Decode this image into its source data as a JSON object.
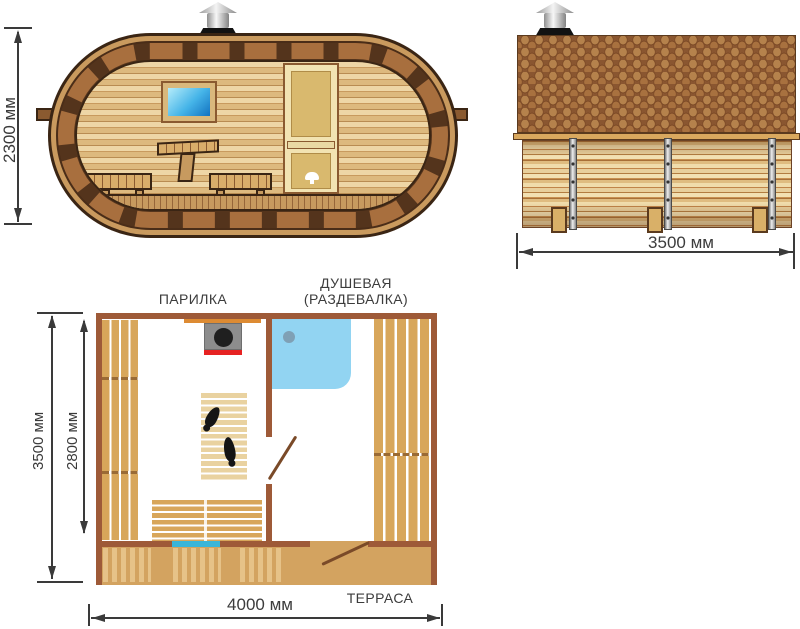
{
  "front_view": {
    "height_dimension": "2300 мм"
  },
  "side_view": {
    "length_dimension": "3500 мм"
  },
  "floor_plan": {
    "room_labels": {
      "steam_room": "ПАРИЛКА",
      "shower_line1": "ДУШЕВАЯ",
      "shower_line2": "(РАЗДЕВАЛКА)",
      "terrace": "ТЕРРАСА"
    },
    "dimensions": {
      "overall_depth": "3500 мм",
      "interior_depth": "2800 мм",
      "overall_width": "4000 мм"
    }
  },
  "colors": {
    "plan_wall_brown": "#9e5a38",
    "wood_tan": "#d8a65a",
    "barrel_dark_brown": "#3a2514",
    "stave_tan": "#a86f3e",
    "shower_blue": "#92d4f2",
    "mat_cyan": "#3ab5d8",
    "stove_red": "#e62222",
    "dimension_line": "#3a3a3a"
  }
}
